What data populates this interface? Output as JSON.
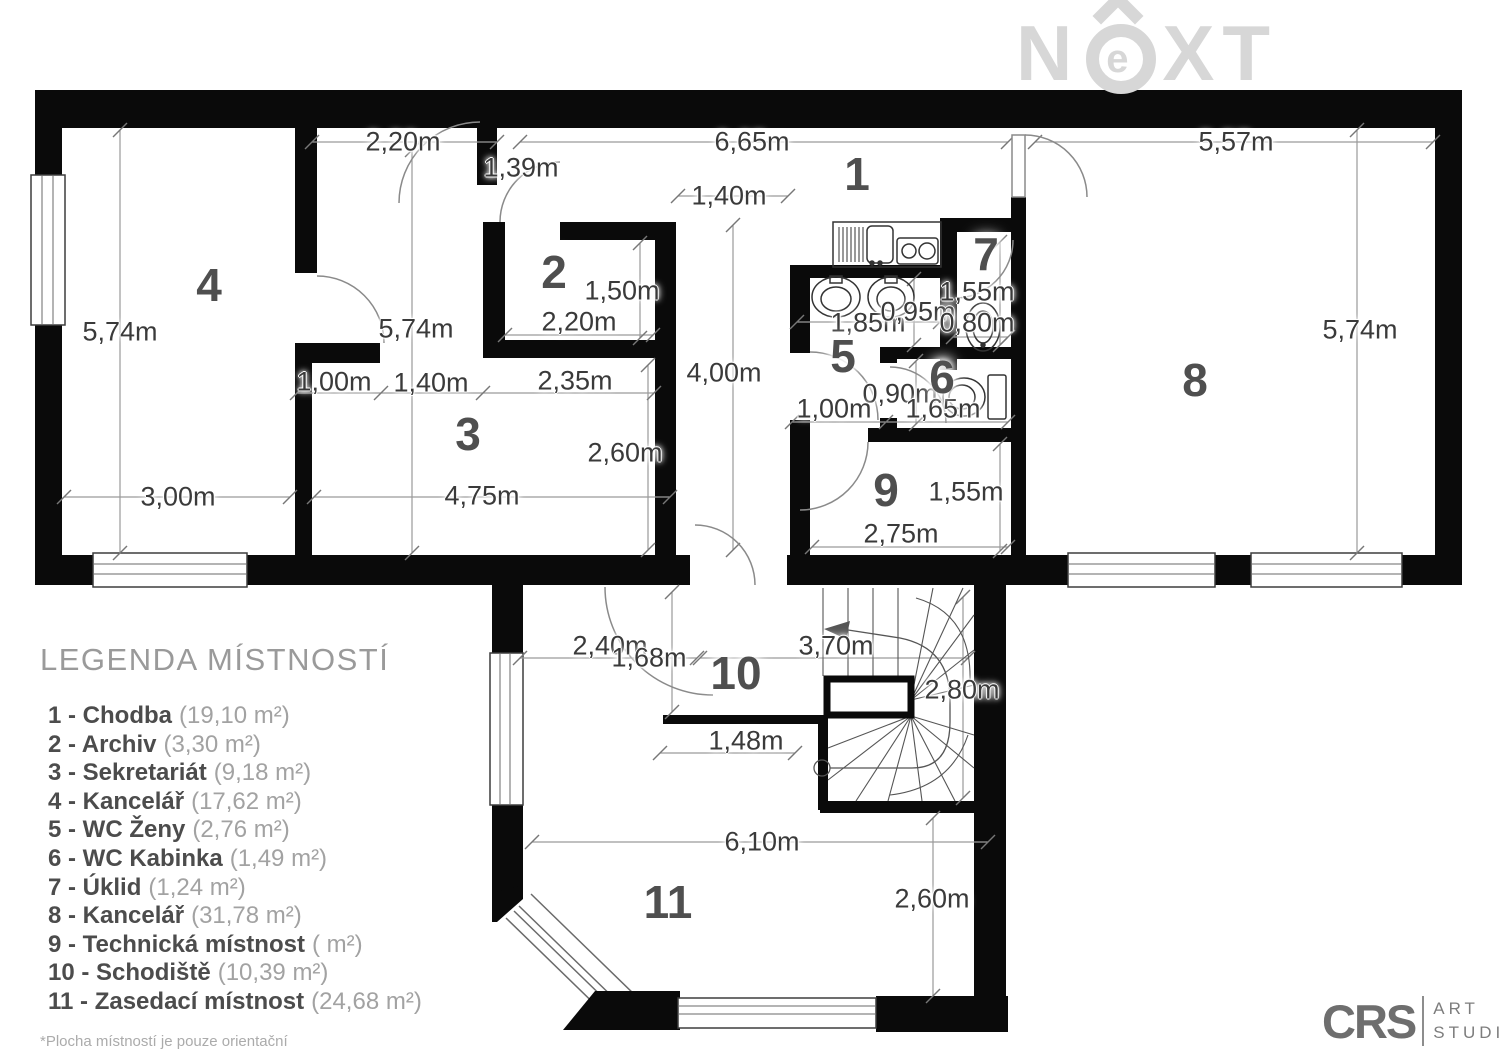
{
  "watermark": {
    "n": "N",
    "e": "e",
    "xt": "XT"
  },
  "colors": {
    "wall": "#0a0a0a",
    "dimension_text": "#3a3a3a",
    "room_number_text": "#4f4f4f",
    "dimension_line": "#9a9a9a",
    "watermark_gray": "#d7d7d7",
    "legend_gray": "#9a9a9a"
  },
  "plan": {
    "room_numbers": [
      {
        "n": "1",
        "x": 857,
        "y": 174
      },
      {
        "n": "2",
        "x": 554,
        "y": 272
      },
      {
        "n": "3",
        "x": 468,
        "y": 434
      },
      {
        "n": "4",
        "x": 209,
        "y": 285
      },
      {
        "n": "5",
        "x": 843,
        "y": 356
      },
      {
        "n": "6",
        "x": 942,
        "y": 377
      },
      {
        "n": "7",
        "x": 986,
        "y": 254
      },
      {
        "n": "8",
        "x": 1195,
        "y": 380
      },
      {
        "n": "9",
        "x": 886,
        "y": 490
      },
      {
        "n": "10",
        "x": 736,
        "y": 673
      },
      {
        "n": "11",
        "x": 668,
        "y": 902
      }
    ],
    "dimensions": [
      {
        "t": "2,20m",
        "x": 403,
        "y": 142
      },
      {
        "t": "1,39m",
        "x": 521,
        "y": 168
      },
      {
        "t": "6,65m",
        "x": 752,
        "y": 142
      },
      {
        "t": "1,40m",
        "x": 729,
        "y": 196
      },
      {
        "t": "5,57m",
        "x": 1236,
        "y": 142
      },
      {
        "t": "5,74m",
        "x": 120,
        "y": 332
      },
      {
        "t": "5,74m",
        "x": 416,
        "y": 329
      },
      {
        "t": "5,74m",
        "x": 1360,
        "y": 330
      },
      {
        "t": "1,50m",
        "x": 622,
        "y": 291
      },
      {
        "t": "2,20m",
        "x": 579,
        "y": 322
      },
      {
        "t": "1,00m",
        "x": 334,
        "y": 382
      },
      {
        "t": "1,40m",
        "x": 431,
        "y": 383
      },
      {
        "t": "2,35m",
        "x": 575,
        "y": 381
      },
      {
        "t": "4,00m",
        "x": 724,
        "y": 373
      },
      {
        "t": "1,85m",
        "x": 868,
        "y": 323
      },
      {
        "t": "0,95m",
        "x": 918,
        "y": 312
      },
      {
        "t": "1,55m",
        "x": 977,
        "y": 292
      },
      {
        "t": "0,80m",
        "x": 977,
        "y": 323
      },
      {
        "t": "0,90m",
        "x": 900,
        "y": 394
      },
      {
        "t": "1,65m",
        "x": 943,
        "y": 409
      },
      {
        "t": "1,00m",
        "x": 834,
        "y": 409
      },
      {
        "t": "2,60m",
        "x": 625,
        "y": 453
      },
      {
        "t": "3,00m",
        "x": 178,
        "y": 497
      },
      {
        "t": "4,75m",
        "x": 482,
        "y": 496
      },
      {
        "t": "1,55m",
        "x": 966,
        "y": 492
      },
      {
        "t": "2,75m",
        "x": 901,
        "y": 534
      },
      {
        "t": "2,40m",
        "x": 610,
        "y": 646
      },
      {
        "t": "1,68m",
        "x": 649,
        "y": 658
      },
      {
        "t": "3,70m",
        "x": 836,
        "y": 646
      },
      {
        "t": "2,80m",
        "x": 962,
        "y": 690
      },
      {
        "t": "1,48m",
        "x": 746,
        "y": 741
      },
      {
        "t": "6,10m",
        "x": 762,
        "y": 842
      },
      {
        "t": "2,60m",
        "x": 932,
        "y": 899
      }
    ]
  },
  "legend": {
    "title": "LEGENDA MÍSTNOSTÍ",
    "items": [
      {
        "label": "1 - Chodba",
        "area": "(19,10 m²)"
      },
      {
        "label": "2 - Archiv",
        "area": "(3,30 m²)"
      },
      {
        "label": "3 - Sekretariát",
        "area": "(9,18 m²)"
      },
      {
        "label": "4 - Kancelář",
        "area": "(17,62 m²)"
      },
      {
        "label": "5 - WC Ženy",
        "area": "(2,76 m²)"
      },
      {
        "label": "6 - WC Kabinka",
        "area": "(1,49 m²)"
      },
      {
        "label": "7 - Úklid",
        "area": "(1,24 m²)"
      },
      {
        "label": "8 - Kancelář",
        "area": "(31,78 m²)"
      },
      {
        "label": "9 - Technická místnost",
        "area": "( m²)"
      },
      {
        "label": "10 - Schodiště",
        "area": "(10,39 m²)"
      },
      {
        "label": "11 - Zasedací místnost",
        "area": "(24,68 m²)"
      }
    ],
    "footnote": "*Plocha místností je pouze orientační"
  },
  "footer_logo": {
    "crs": "CRS",
    "line1": "ART",
    "line2": "STUDIO"
  }
}
